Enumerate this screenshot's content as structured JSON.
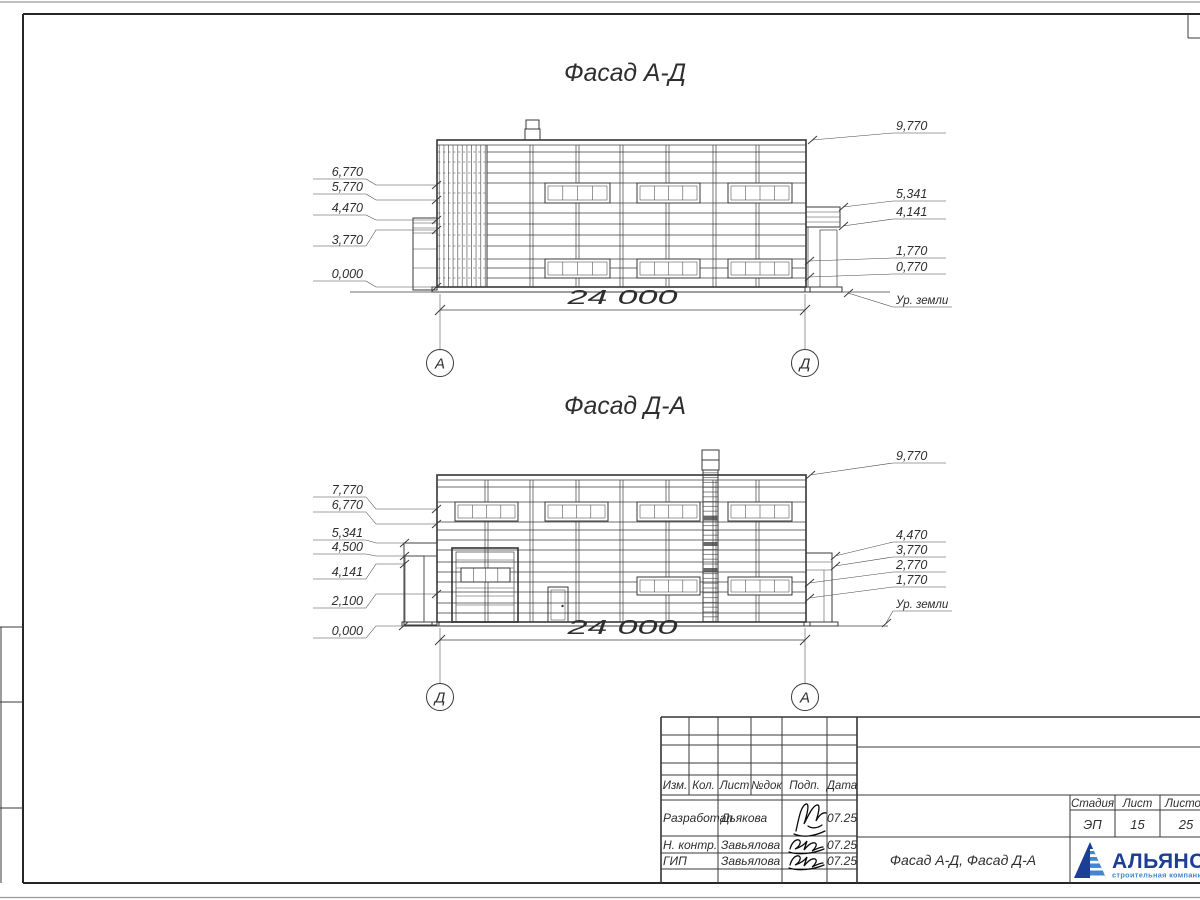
{
  "facade_top": {
    "title": "Фасад А-Д",
    "dim": "24 000",
    "axis_left": "А",
    "axis_right": "Д",
    "ground": "Ур. земли",
    "elev": {
      "l1": "6,770",
      "l2": "5,770",
      "l3": "4,470",
      "l4": "3,770",
      "l5": "0,000",
      "r1": "9,770",
      "r2": "5,341",
      "r3": "4,141",
      "r4": "1,770",
      "r5": "0,770"
    }
  },
  "facade_bottom": {
    "title": "Фасад Д-А",
    "dim": "24 000",
    "axis_left": "Д",
    "axis_right": "А",
    "ground": "Ур. земли",
    "elev": {
      "l1": "7,770",
      "l2": "6,770",
      "l3": "5,341",
      "l4": "4,500",
      "l5": "4,141",
      "l6": "2,100",
      "l7": "0,000",
      "r1": "9,770",
      "r2": "4,470",
      "r3": "3,770",
      "r4": "2,770",
      "r5": "1,770"
    }
  },
  "titleblock": {
    "col_izm": "Изм.",
    "col_kol": "Кол.",
    "col_list": "Лист",
    "col_ndok": "№док",
    "col_podp": "Подп.",
    "col_data": "Дата",
    "row1_role": "Разработал",
    "row1_name": "Дьякова",
    "row1_date": "07.25",
    "row2_role": "Н. контр.",
    "row2_name": "Завьялова",
    "row2_date": "07.25",
    "row3_role": "ГИП",
    "row3_name": "Завьялова",
    "row3_date": "07.25",
    "doc_title": "Фасад А-Д, Фасад Д-А",
    "stage_h": "Стадия",
    "list_h": "Лист",
    "listov_h": "Листов",
    "stage": "ЭП",
    "list": "15",
    "listov": "25",
    "logo_name": "АЛЬЯНС",
    "logo_tagline": "строительная компания"
  },
  "colors": {
    "logo_dark": "#1c3e95",
    "logo_light": "#4186cf",
    "line": "#3a3a3a"
  }
}
